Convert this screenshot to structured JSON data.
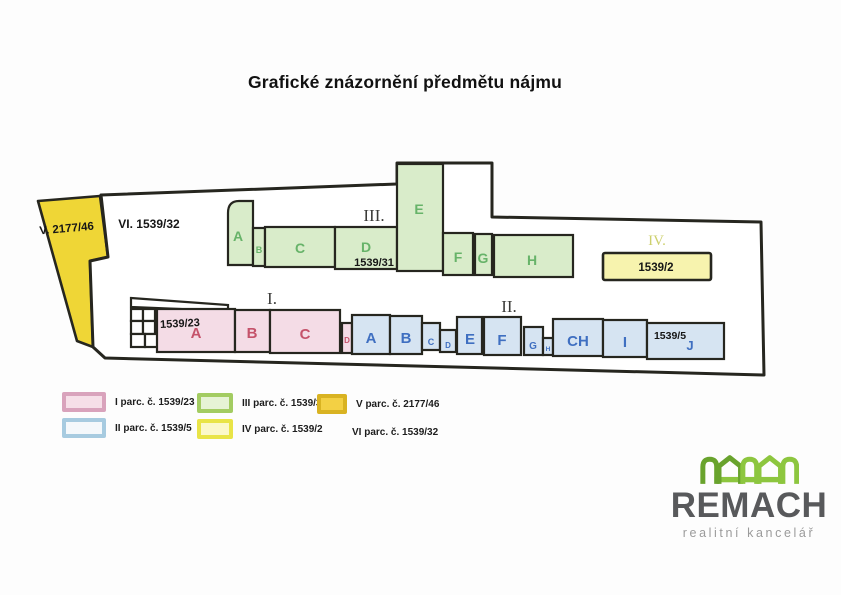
{
  "title": "Grafické znázornění předmětu nájmu",
  "plan": {
    "outer_left_label": "V. 2177/46",
    "outer_area_label": "VI. 1539/32",
    "section_i": {
      "numeral": "I.",
      "parcel": "1539/23",
      "units": [
        "A",
        "B",
        "C",
        "D"
      ]
    },
    "section_ii": {
      "numeral": "II.",
      "parcel": "1539/5",
      "units": [
        "A",
        "B",
        "C",
        "D",
        "E",
        "F",
        "G",
        "H",
        "CH",
        "I",
        "J"
      ]
    },
    "section_iii": {
      "numeral": "III.",
      "parcel": "1539/31",
      "units": [
        "A",
        "B",
        "C",
        "D",
        "E",
        "F",
        "G",
        "H"
      ]
    },
    "section_iv": {
      "numeral": "IV.",
      "parcel": "1539/2"
    }
  },
  "legend": {
    "items": [
      {
        "label": "I parc. č. 1539/23",
        "fill": "#f6dfe8",
        "border": "#d9a3bc"
      },
      {
        "label": "II parc. č. 1539/5",
        "fill": "#f4f8fb",
        "border": "#a7cbe0"
      },
      {
        "label": "III parc. č. 1539/31",
        "fill": "#e6f3d5",
        "border": "#a3cc62"
      },
      {
        "label": "IV parc. č. 1539/2",
        "fill": "#fbf8c9",
        "border": "#e9e447"
      },
      {
        "label": "V parc. č. 2177/46",
        "fill": "#f3d044",
        "border": "#d9b322"
      },
      {
        "label": "VI parc. č. 1539/32"
      }
    ]
  },
  "logo": {
    "brand": "REMACH",
    "tagline": "realitní kancelář",
    "green_dark": "#69a32d",
    "green_light": "#8dc63f",
    "gray": "#58595b"
  },
  "colors": {
    "pink_fill": "#f4dce6",
    "pink_text": "#c5536b",
    "blue_fill": "#d6e4f2",
    "blue_text": "#3f6fc1",
    "green_fill": "#d9ecca",
    "green_text": "#67b369",
    "yellow_strong": "#efd636",
    "yellow_pale": "#f7f3ae",
    "outline": "#26261f"
  }
}
